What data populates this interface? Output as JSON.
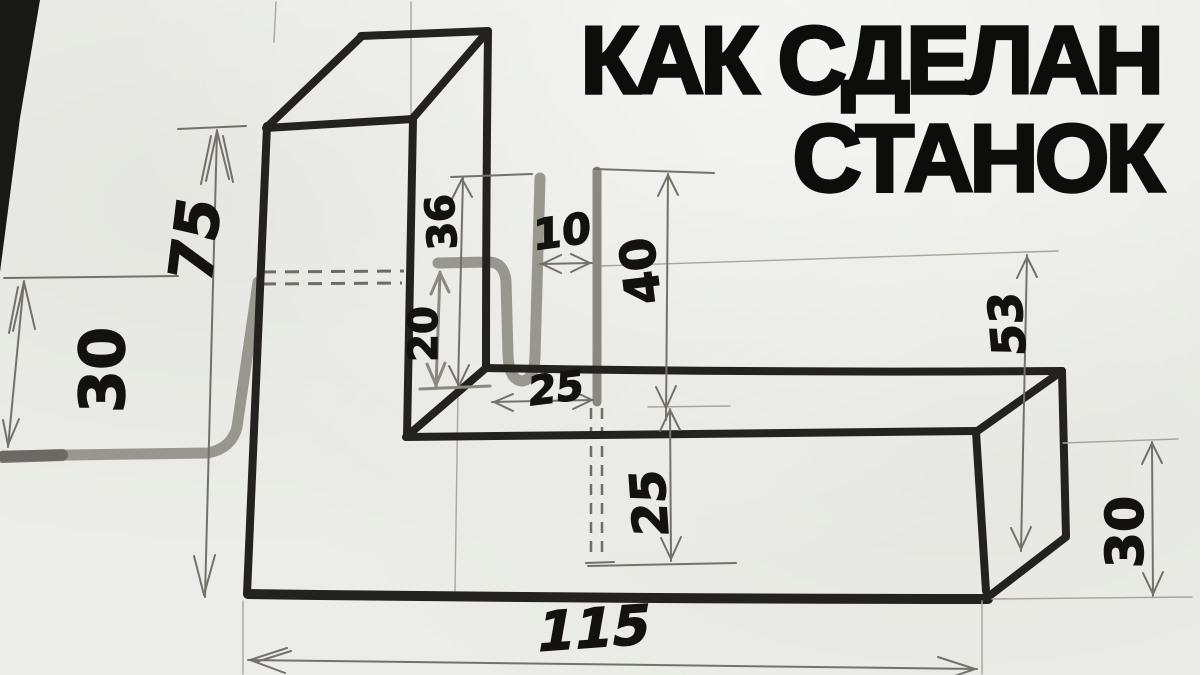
{
  "title": {
    "line1": "КАК СДЕЛАН",
    "line2": "СТАНОК"
  },
  "drawing": {
    "kind": "hand-drawn isometric pencil sketch of an L-shaped rod-bending jig",
    "parts": [
      "vertical-column",
      "horizontal-bar",
      "bent-rod",
      "pin"
    ],
    "dimensions": {
      "column_height": "75",
      "rod_tail": "30",
      "pin_above_shelf": "36",
      "hole_height": "20",
      "rod_pin_gap": "10",
      "pin_height": "40",
      "pin_from_corner": "25",
      "pin_embed_depth": "25",
      "bar_section_height": "53",
      "bar_section_depth": "30",
      "bar_length": "115"
    },
    "colors": {
      "paper": "#ecede8",
      "ink": "#24221f",
      "pencil": "#94928a",
      "title_text": "#0d0d0b",
      "photo_background": "#181815"
    }
  }
}
